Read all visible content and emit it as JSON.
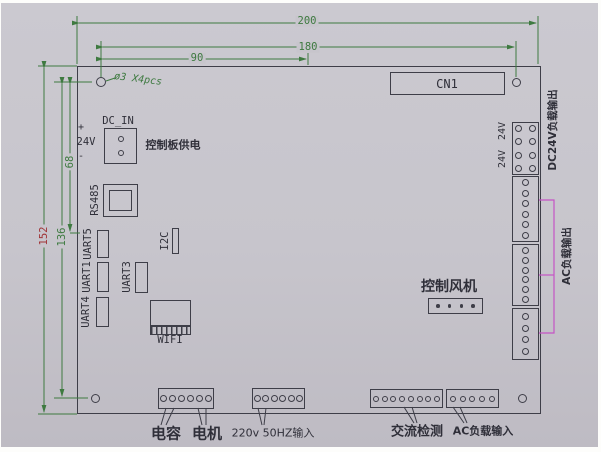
{
  "dims": {
    "d200": "200",
    "d180": "180",
    "d90": "90",
    "d152": "152",
    "d136": "136",
    "d68": "68"
  },
  "hole_note": "ø3 X4pcs",
  "labels": {
    "cn1": "CN1",
    "dc_in": "DC_IN",
    "dc_in_plus": "+",
    "dc_in_minus": "-",
    "dc_in_voltage": "24V",
    "dc_in_note": "控制板供电",
    "rs485": "RS485",
    "uart5": "UART5",
    "uart1": "UART1",
    "uart4": "UART4",
    "uart3": "UART3",
    "i2c": "I2C",
    "wifi": "WIFI",
    "fan": "控制风机",
    "v24_upper": "24V",
    "v24_lower": "24V",
    "dc24v_out": "DC24V负载输出",
    "ac_out": "AC负载输出",
    "capacitor": "电容",
    "motor": "电机",
    "mains_in": "220v 50HZ输入",
    "ac_detect": "交流检测",
    "ac_load_in": "AC负载输入"
  },
  "pins": {
    "dc_in": 2,
    "v24_block": 8,
    "ac_block_1": 6,
    "ac_block_2": 6,
    "ac_block_3": 4,
    "fan": 4,
    "cap_motor": 6,
    "mains": 6,
    "ac_detect": 8,
    "ac_load": 5
  },
  "colors": {
    "dimension_green": "#3e7a40",
    "dimension_red": "#a03336",
    "bracket_magenta": "#c554c5",
    "line_dark": "#3e3e48",
    "photo_background": "#c7c5cc"
  }
}
